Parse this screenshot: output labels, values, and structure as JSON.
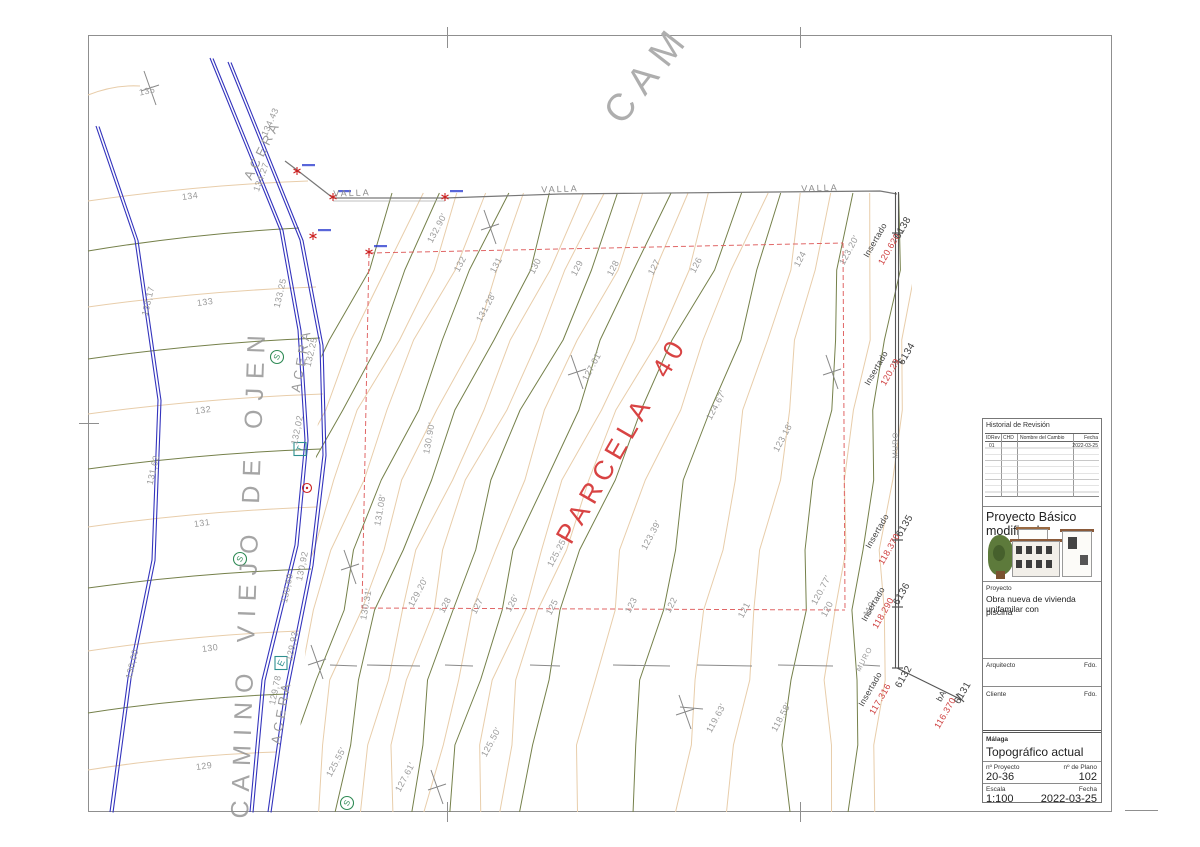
{
  "drawing": {
    "top_road_label": "CAM",
    "road_name": "CAMINO VIEJO DE OJEN",
    "parcel_label": "PARCELA 40",
    "acera_labels": [
      {
        "text": "ACERA",
        "x": 262,
        "y": 150,
        "rot": -63
      },
      {
        "text": "ACERA",
        "x": 301,
        "y": 360,
        "rot": -80
      },
      {
        "text": "ACERA",
        "x": 281,
        "y": 712,
        "rot": -80
      }
    ],
    "valla_labels": [
      {
        "text": "VALLA",
        "x": 352,
        "y": 193,
        "rot": -2
      },
      {
        "text": "VALLA",
        "x": 560,
        "y": 189,
        "rot": -2
      },
      {
        "text": "VALLA",
        "x": 820,
        "y": 188,
        "rot": -2
      }
    ],
    "muro_labels": [
      {
        "text": "MURO",
        "x": 895,
        "y": 445,
        "rot": -90
      },
      {
        "text": "MURO",
        "x": 864,
        "y": 659,
        "rot": -62
      }
    ],
    "contour_labels": [
      {
        "text": "135",
        "x": 147,
        "y": 91,
        "rot": -12
      },
      {
        "text": "134.43",
        "x": 270,
        "y": 122,
        "rot": -66
      },
      {
        "text": "134.27",
        "x": 261,
        "y": 177,
        "rot": -70
      },
      {
        "text": "134",
        "x": 190,
        "y": 196,
        "rot": -8
      },
      {
        "text": "133,17",
        "x": 148,
        "y": 301,
        "rot": -77
      },
      {
        "text": "133",
        "x": 205,
        "y": 302,
        "rot": -8
      },
      {
        "text": "133.25",
        "x": 280,
        "y": 293,
        "rot": -77
      },
      {
        "text": "132.25",
        "x": 311,
        "y": 352,
        "rot": -77
      },
      {
        "text": "132",
        "x": 203,
        "y": 410,
        "rot": -8
      },
      {
        "text": "132,02",
        "x": 297,
        "y": 430,
        "rot": -78
      },
      {
        "text": "131,62",
        "x": 153,
        "y": 470,
        "rot": -77
      },
      {
        "text": "131",
        "x": 202,
        "y": 523,
        "rot": -8
      },
      {
        "text": "130,92",
        "x": 302,
        "y": 566,
        "rot": -78
      },
      {
        "text": "130,69",
        "x": 287,
        "y": 588,
        "rot": -78
      },
      {
        "text": "130",
        "x": 210,
        "y": 648,
        "rot": -8
      },
      {
        "text": "130,00",
        "x": 132,
        "y": 664,
        "rot": -77
      },
      {
        "text": "129,93",
        "x": 292,
        "y": 646,
        "rot": -78
      },
      {
        "text": "129,78",
        "x": 275,
        "y": 690,
        "rot": -78
      },
      {
        "text": "129",
        "x": 204,
        "y": 766,
        "rot": -8
      },
      {
        "text": "132.90'",
        "x": 437,
        "y": 228,
        "rot": -62
      },
      {
        "text": "132",
        "x": 460,
        "y": 264,
        "rot": -62
      },
      {
        "text": "131",
        "x": 496,
        "y": 265,
        "rot": -62
      },
      {
        "text": "130",
        "x": 535,
        "y": 266,
        "rot": -62
      },
      {
        "text": "129",
        "x": 577,
        "y": 268,
        "rot": -62
      },
      {
        "text": "128",
        "x": 613,
        "y": 268,
        "rot": -62
      },
      {
        "text": "127",
        "x": 654,
        "y": 267,
        "rot": -62
      },
      {
        "text": "126",
        "x": 696,
        "y": 265,
        "rot": -62
      },
      {
        "text": "124",
        "x": 800,
        "y": 259,
        "rot": -62
      },
      {
        "text": "123.20'",
        "x": 849,
        "y": 250,
        "rot": -62
      },
      {
        "text": "131.28'",
        "x": 486,
        "y": 307,
        "rot": -62
      },
      {
        "text": "127.01'",
        "x": 592,
        "y": 366,
        "rot": -62
      },
      {
        "text": "130.90'",
        "x": 429,
        "y": 438,
        "rot": -80
      },
      {
        "text": "131.08'",
        "x": 380,
        "y": 510,
        "rot": -80
      },
      {
        "text": "125.25'",
        "x": 557,
        "y": 552,
        "rot": -62
      },
      {
        "text": "124.67'",
        "x": 716,
        "y": 405,
        "rot": -62
      },
      {
        "text": "123.18'",
        "x": 783,
        "y": 437,
        "rot": -62
      },
      {
        "text": "123.39'",
        "x": 651,
        "y": 535,
        "rot": -62
      },
      {
        "text": "130.31'",
        "x": 366,
        "y": 604,
        "rot": -80
      },
      {
        "text": "129.20'",
        "x": 418,
        "y": 592,
        "rot": -62
      },
      {
        "text": "128",
        "x": 445,
        "y": 605,
        "rot": -62
      },
      {
        "text": "127",
        "x": 477,
        "y": 606,
        "rot": -62
      },
      {
        "text": "126'",
        "x": 512,
        "y": 603,
        "rot": -62
      },
      {
        "text": "125",
        "x": 552,
        "y": 607,
        "rot": -62
      },
      {
        "text": "123",
        "x": 631,
        "y": 605,
        "rot": -62
      },
      {
        "text": "122",
        "x": 671,
        "y": 605,
        "rot": -62
      },
      {
        "text": "121",
        "x": 744,
        "y": 610,
        "rot": -62
      },
      {
        "text": "120.77'",
        "x": 821,
        "y": 590,
        "rot": -62
      },
      {
        "text": "120",
        "x": 827,
        "y": 609,
        "rot": -62
      },
      {
        "text": "119",
        "x": 869,
        "y": 609,
        "rot": -62
      },
      {
        "text": "119.63'",
        "x": 716,
        "y": 718,
        "rot": -62
      },
      {
        "text": "118.58'",
        "x": 781,
        "y": 717,
        "rot": -62
      },
      {
        "text": "125.50'",
        "x": 491,
        "y": 742,
        "rot": -62
      },
      {
        "text": "127.61'",
        "x": 405,
        "y": 777,
        "rot": -62
      },
      {
        "text": "125.55'",
        "x": 336,
        "y": 762,
        "rot": -62
      }
    ],
    "survey_points": [
      {
        "label": "Insertado",
        "elevation": "120.620",
        "point_id": "6138",
        "label_pos": [
          875,
          240
        ],
        "elev_pos": [
          889,
          249
        ],
        "id_pos": [
          903,
          228
        ]
      },
      {
        "label": "Insertado",
        "elevation": "120.29",
        "point_id": "6134",
        "label_pos": [
          876,
          368
        ],
        "elev_pos": [
          890,
          372
        ],
        "id_pos": [
          907,
          354
        ]
      },
      {
        "label": "Insertado",
        "elevation": "118.370",
        "point_id": "6135",
        "label_pos": [
          877,
          531
        ],
        "elev_pos": [
          889,
          549
        ],
        "id_pos": [
          905,
          526
        ]
      },
      {
        "label": "Insertado",
        "elevation": "118.290",
        "point_id": "6136",
        "label_pos": [
          873,
          604
        ],
        "elev_pos": [
          883,
          613
        ],
        "id_pos": [
          902,
          594
        ]
      },
      {
        "label": "Insertado",
        "elevation": "117.316",
        "point_id": "6132",
        "label_pos": [
          870,
          689
        ],
        "elev_pos": [
          880,
          699
        ],
        "id_pos": [
          904,
          677
        ]
      },
      {
        "label": "bA",
        "elevation": "116.370",
        "point_id": "6131",
        "label_pos": [
          941,
          696
        ],
        "elev_pos": [
          945,
          713
        ],
        "id_pos": [
          963,
          693
        ]
      }
    ],
    "symbols": [
      {
        "glyph": "S",
        "kind": "circle-green",
        "x": 277,
        "y": 357
      },
      {
        "glyph": "S",
        "kind": "circle-green",
        "x": 240,
        "y": 559
      },
      {
        "glyph": "S",
        "kind": "circle-green",
        "x": 347,
        "y": 803
      },
      {
        "glyph": "T",
        "kind": "box-teal",
        "x": 300,
        "y": 449
      },
      {
        "glyph": "E",
        "kind": "box-teal",
        "x": 281,
        "y": 663
      }
    ]
  },
  "title_block": {
    "revision": {
      "title": "Historial de Revisión",
      "columns": [
        "IDRev",
        "CHD",
        "Nombre del Cambio",
        "Fecha"
      ],
      "rows": [
        [
          "01",
          "",
          "",
          "2022-03-25"
        ]
      ]
    },
    "project_title": "Proyecto Básico modificado",
    "project_label": "Proyecto",
    "project_description_1": "Obra nueva de vivienda unifamilar con",
    "project_description_2": "piscina",
    "architect_label": "Arquitecto",
    "client_label": "Cliente",
    "signature_label": "Fdo.",
    "location": "Málaga",
    "sheet_name": "Topográfico actual",
    "project_no_label": "nº Proyecto",
    "project_no": "20-36",
    "plan_no_label": "nº de Plano",
    "plan_no": "102",
    "scale_label": "Escala",
    "scale": "1:100",
    "date_label": "Fecha",
    "date": "2022-03-25"
  },
  "colors": {
    "contour_minor": "#e8cdaa",
    "contour_major": "#75804a",
    "road_blue": "#3434bd",
    "boundary_red": "#e06666",
    "accent_red": "#d84343",
    "label_gray": "#9b9b9b",
    "fence_gray": "#777777",
    "marker_red": "#cc2222",
    "station_blue": "#2233cc"
  }
}
